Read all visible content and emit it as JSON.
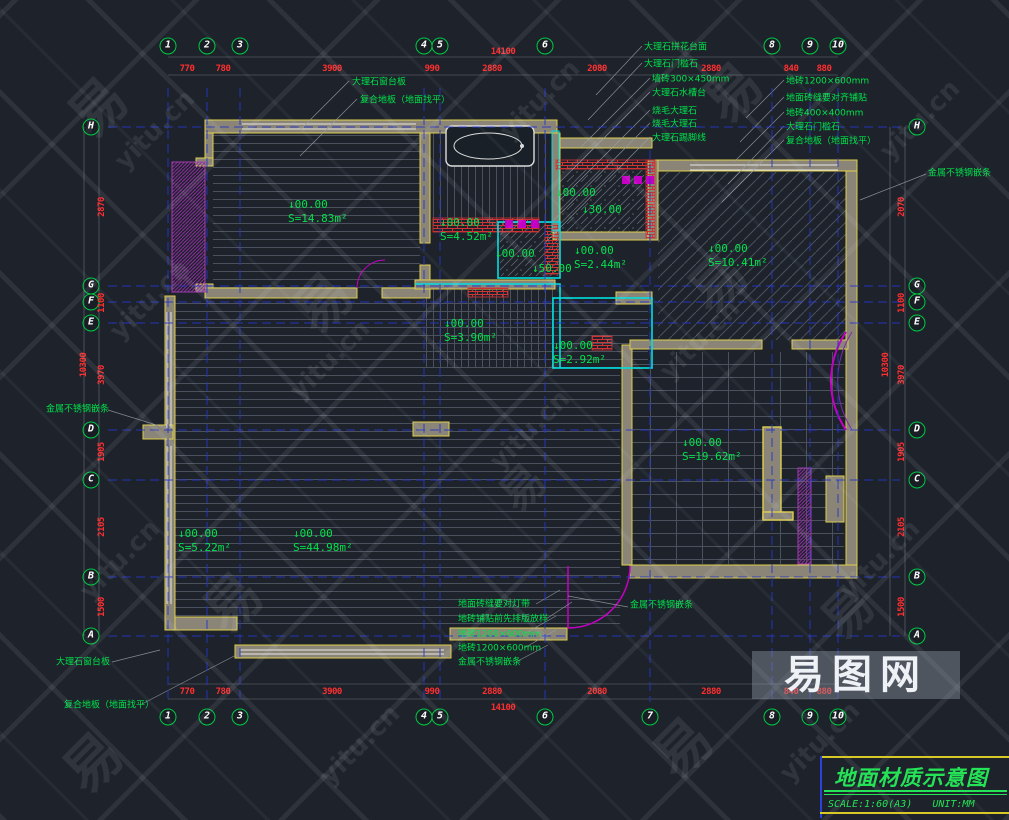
{
  "colors": {
    "background": "#1d222b",
    "wall_fill": "#8a8577",
    "wall_edge": "#e0cf4e",
    "cyan": "#00e0e0",
    "magenta": "#c400c4",
    "red_dim": "#ff2f2f",
    "green_text": "#00e34a",
    "grid_blue": "#2636c8",
    "white": "#e6e6e6"
  },
  "title_block": {
    "title": "地面材质示意图",
    "scale_label": "SCALE:1:60(A3)",
    "unit_label": "UNIT:MM"
  },
  "watermark": {
    "logo_text": "易图网",
    "tiles": [
      {
        "t": "易",
        "x": 95,
        "y": 105,
        "s": 56
      },
      {
        "t": "yitu.cn",
        "x": 155,
        "y": 130,
        "s": 26
      },
      {
        "t": "yitu.cn",
        "x": 540,
        "y": 100,
        "s": 26
      },
      {
        "t": "易",
        "x": 730,
        "y": 90,
        "s": 56
      },
      {
        "t": "yitu.cn",
        "x": 920,
        "y": 120,
        "s": 26
      },
      {
        "t": "yitu.cn",
        "x": 150,
        "y": 300,
        "s": 26
      },
      {
        "t": "易",
        "x": 320,
        "y": 300,
        "s": 56
      },
      {
        "t": "yitu.cn",
        "x": 330,
        "y": 360,
        "s": 26
      },
      {
        "t": "易",
        "x": 715,
        "y": 280,
        "s": 56
      },
      {
        "t": "yitu.cn",
        "x": 700,
        "y": 340,
        "s": 26
      },
      {
        "t": "yitu.cn",
        "x": 120,
        "y": 560,
        "s": 26
      },
      {
        "t": "易",
        "x": 230,
        "y": 600,
        "s": 56
      },
      {
        "t": "yitu.cn",
        "x": 530,
        "y": 430,
        "s": 26
      },
      {
        "t": "易",
        "x": 520,
        "y": 485,
        "s": 44
      },
      {
        "t": "yitu.cn",
        "x": 880,
        "y": 560,
        "s": 26
      },
      {
        "t": "易",
        "x": 845,
        "y": 610,
        "s": 50
      },
      {
        "t": "yitu.cn",
        "x": 360,
        "y": 745,
        "s": 26
      },
      {
        "t": "易",
        "x": 680,
        "y": 745,
        "s": 56
      },
      {
        "t": "yitu.cn",
        "x": 820,
        "y": 742,
        "s": 26
      },
      {
        "t": "易",
        "x": 90,
        "y": 760,
        "s": 56
      }
    ]
  },
  "grid_bubbles": {
    "top": [
      {
        "label": "1",
        "x": 168,
        "y": 46
      },
      {
        "label": "2",
        "x": 207,
        "y": 46
      },
      {
        "label": "3",
        "x": 240,
        "y": 46
      },
      {
        "label": "4",
        "x": 424,
        "y": 46
      },
      {
        "label": "5",
        "x": 440,
        "y": 46
      },
      {
        "label": "6",
        "x": 545,
        "y": 46
      },
      {
        "label": "8",
        "x": 772,
        "y": 46
      },
      {
        "label": "9",
        "x": 810,
        "y": 46
      },
      {
        "label": "10",
        "x": 838,
        "y": 46
      }
    ],
    "bottom": [
      {
        "label": "1",
        "x": 168,
        "y": 717
      },
      {
        "label": "2",
        "x": 207,
        "y": 717
      },
      {
        "label": "3",
        "x": 240,
        "y": 717
      },
      {
        "label": "4",
        "x": 424,
        "y": 717
      },
      {
        "label": "5",
        "x": 440,
        "y": 717
      },
      {
        "label": "6",
        "x": 545,
        "y": 717
      },
      {
        "label": "7",
        "x": 650,
        "y": 717
      },
      {
        "label": "8",
        "x": 772,
        "y": 717
      },
      {
        "label": "9",
        "x": 810,
        "y": 717
      },
      {
        "label": "10",
        "x": 838,
        "y": 717
      }
    ],
    "left": [
      {
        "label": "H",
        "x": 91,
        "y": 127
      },
      {
        "label": "G",
        "x": 91,
        "y": 286
      },
      {
        "label": "F",
        "x": 91,
        "y": 302
      },
      {
        "label": "E",
        "x": 91,
        "y": 323
      },
      {
        "label": "D",
        "x": 91,
        "y": 430
      },
      {
        "label": "C",
        "x": 91,
        "y": 480
      },
      {
        "label": "B",
        "x": 91,
        "y": 577
      },
      {
        "label": "A",
        "x": 91,
        "y": 636
      }
    ],
    "right": [
      {
        "label": "H",
        "x": 917,
        "y": 127
      },
      {
        "label": "G",
        "x": 917,
        "y": 286
      },
      {
        "label": "F",
        "x": 917,
        "y": 302
      },
      {
        "label": "E",
        "x": 917,
        "y": 323
      },
      {
        "label": "D",
        "x": 917,
        "y": 430
      },
      {
        "label": "C",
        "x": 917,
        "y": 480
      },
      {
        "label": "B",
        "x": 917,
        "y": 577
      },
      {
        "label": "A",
        "x": 917,
        "y": 636
      }
    ]
  },
  "dimensions": {
    "top": [
      {
        "t": "14100",
        "x": 503,
        "y": 52
      },
      {
        "t": "770",
        "x": 187,
        "y": 69
      },
      {
        "t": "780",
        "x": 223,
        "y": 69
      },
      {
        "t": "3900",
        "x": 332,
        "y": 69
      },
      {
        "t": "990",
        "x": 432,
        "y": 69
      },
      {
        "t": "2880",
        "x": 492,
        "y": 69
      },
      {
        "t": "2080",
        "x": 597,
        "y": 69
      },
      {
        "t": "2880",
        "x": 711,
        "y": 69
      },
      {
        "t": "840",
        "x": 791,
        "y": 69
      },
      {
        "t": "880",
        "x": 824,
        "y": 69
      }
    ],
    "bottom": [
      {
        "t": "770",
        "x": 187,
        "y": 692
      },
      {
        "t": "780",
        "x": 223,
        "y": 692
      },
      {
        "t": "3900",
        "x": 332,
        "y": 692
      },
      {
        "t": "990",
        "x": 432,
        "y": 692
      },
      {
        "t": "2880",
        "x": 492,
        "y": 692
      },
      {
        "t": "2080",
        "x": 597,
        "y": 692
      },
      {
        "t": "2880",
        "x": 711,
        "y": 692
      },
      {
        "t": "840",
        "x": 791,
        "y": 692
      },
      {
        "t": "880",
        "x": 824,
        "y": 692
      },
      {
        "t": "14100",
        "x": 503,
        "y": 708
      }
    ],
    "left": [
      {
        "t": "2870",
        "x": 102,
        "y": 207,
        "cls": "v"
      },
      {
        "t": "1100",
        "x": 102,
        "y": 303,
        "cls": "v"
      },
      {
        "t": "3970",
        "x": 102,
        "y": 375,
        "cls": "v"
      },
      {
        "t": "1905",
        "x": 102,
        "y": 452,
        "cls": "v"
      },
      {
        "t": "2105",
        "x": 102,
        "y": 527,
        "cls": "v"
      },
      {
        "t": "1500",
        "x": 102,
        "y": 607,
        "cls": "v"
      },
      {
        "t": "10300",
        "x": 84,
        "y": 365,
        "cls": "v"
      }
    ],
    "right": [
      {
        "t": "2070",
        "x": 902,
        "y": 207,
        "cls": "v"
      },
      {
        "t": "1100",
        "x": 902,
        "y": 303,
        "cls": "v"
      },
      {
        "t": "3970",
        "x": 902,
        "y": 375,
        "cls": "v"
      },
      {
        "t": "1905",
        "x": 902,
        "y": 452,
        "cls": "v"
      },
      {
        "t": "2105",
        "x": 902,
        "y": 527,
        "cls": "v"
      },
      {
        "t": "1500",
        "x": 902,
        "y": 607,
        "cls": "v"
      },
      {
        "t": "10300",
        "x": 886,
        "y": 365,
        "cls": "v"
      }
    ]
  },
  "room_labels": [
    {
      "e": "↓00.00",
      "a": "S=14.83m²",
      "x": 288,
      "y": 198
    },
    {
      "e": "↓00.00",
      "a": "S=4.52m²",
      "x": 440,
      "y": 216
    },
    {
      "e": "↓00.00",
      "a": "S=2.44m²",
      "x": 574,
      "y": 244
    },
    {
      "e": "↓00.00",
      "a": "S=10.41m²",
      "x": 708,
      "y": 242
    },
    {
      "e": "↓00.00",
      "a": "S=3.90m²",
      "x": 444,
      "y": 317
    },
    {
      "e": "↓00.00",
      "a": "S=2.92m²",
      "x": 553,
      "y": 339
    },
    {
      "e": "↓00.00",
      "a": "S=19.62m²",
      "x": 682,
      "y": 436
    },
    {
      "e": "↓00.00",
      "a": "S=5.22m²",
      "x": 178,
      "y": 527
    },
    {
      "e": "↓00.00",
      "a": "S=44.98m²",
      "x": 293,
      "y": 527
    }
  ],
  "elevation_marks": [
    {
      "t": "↓00.00",
      "x": 495,
      "y": 247
    },
    {
      "t": "↓50.00",
      "x": 532,
      "y": 262
    },
    {
      "t": "↓00.00",
      "x": 556,
      "y": 186
    },
    {
      "t": "↓30.00",
      "x": 582,
      "y": 203
    }
  ],
  "annotations": {
    "top_left": [
      {
        "t": "大理石窗台板",
        "x": 352,
        "y": 81
      },
      {
        "t": "复合地板（地面找平）",
        "x": 360,
        "y": 99
      }
    ],
    "top_right_col1": [
      {
        "t": "大理石拼花台面",
        "x": 644,
        "y": 46
      },
      {
        "t": "大理石门槛石",
        "x": 644,
        "y": 63
      },
      {
        "t": "墙砖300×450mm",
        "x": 652,
        "y": 78
      },
      {
        "t": "大理石水槽台",
        "x": 652,
        "y": 92
      },
      {
        "t": "烧毛大理石",
        "x": 652,
        "y": 110
      },
      {
        "t": "烧毛大理石",
        "x": 652,
        "y": 123
      },
      {
        "t": "大理石踢脚线",
        "x": 652,
        "y": 137
      }
    ],
    "top_right_col2": [
      {
        "t": "地砖1200×600mm",
        "x": 786,
        "y": 80
      },
      {
        "t": "地面砖缝要对齐铺贴",
        "x": 786,
        "y": 97
      },
      {
        "t": "地砖400×400mm",
        "x": 786,
        "y": 112
      },
      {
        "t": "大理石门槛石",
        "x": 786,
        "y": 126
      },
      {
        "t": "复合地板（地面找平）",
        "x": 786,
        "y": 140
      }
    ],
    "sides": [
      {
        "t": "金属不锈钢嵌条",
        "x": 928,
        "y": 172
      },
      {
        "t": "金属不锈钢嵌条",
        "x": 46,
        "y": 408
      },
      {
        "t": "金属不锈钢嵌条",
        "x": 630,
        "y": 604
      }
    ],
    "bottom": [
      {
        "t": "地面砖缝要对灯带",
        "x": 458,
        "y": 603
      },
      {
        "t": "地砖铺贴前先排版放样",
        "x": 458,
        "y": 618
      },
      {
        "t": "地砖1200×600mm",
        "x": 458,
        "y": 633
      },
      {
        "t": "地砖1200×600mm",
        "x": 458,
        "y": 647
      },
      {
        "t": "金属不锈钢嵌条",
        "x": 458,
        "y": 661
      },
      {
        "t": "大理石窗台板",
        "x": 56,
        "y": 661
      },
      {
        "t": "复合地板（地面找平）",
        "x": 64,
        "y": 704
      }
    ]
  }
}
